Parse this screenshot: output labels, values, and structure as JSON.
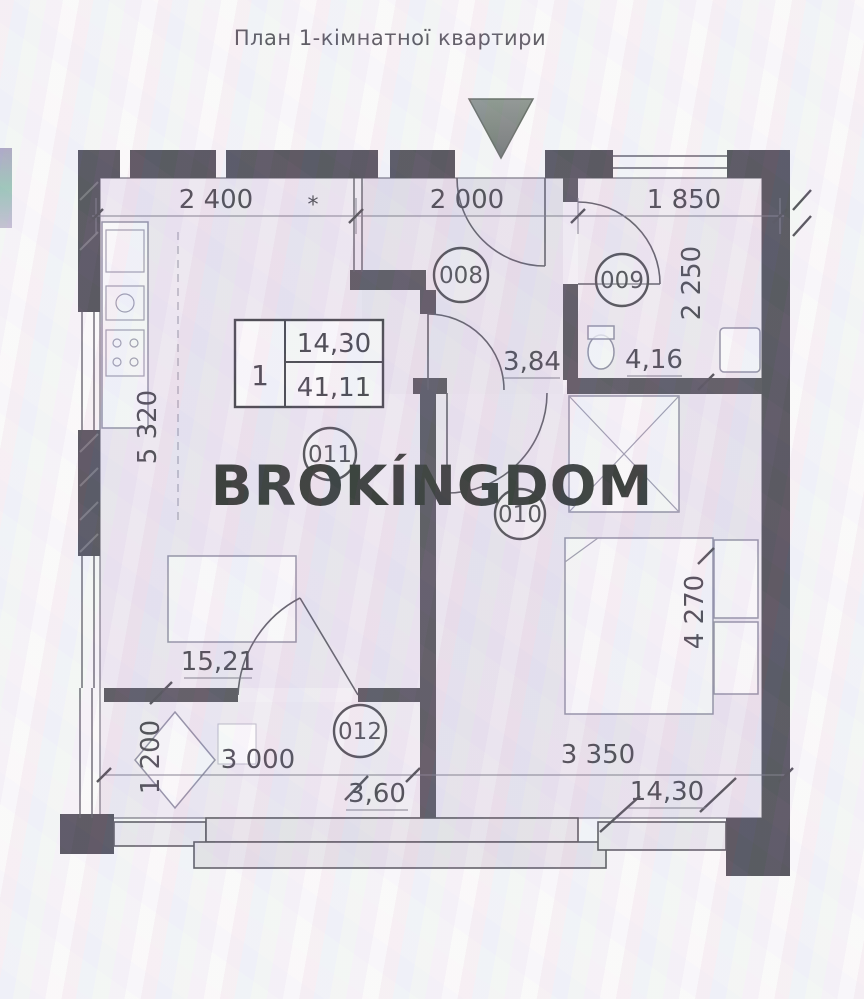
{
  "title": "План 1-кімнатної квартири",
  "watermark": "BROKÍNGDOM",
  "stamp": {
    "flat_number": "1",
    "living_area": "14,30",
    "total_area": "41,11"
  },
  "rooms": [
    {
      "number": "008",
      "area": "3,84"
    },
    {
      "number": "009",
      "area": "4,16"
    },
    {
      "number": "010",
      "area": "14,30"
    },
    {
      "number": "011",
      "area": "15,21"
    },
    {
      "number": "012",
      "area": "3,60"
    }
  ],
  "dimensions": {
    "top": [
      "2 400",
      "2 000",
      "1 850"
    ],
    "top_mark": "*",
    "left_upper": "5 320",
    "left_lower": "1 200",
    "right_upper": "2 250",
    "right_lower": "4 270",
    "bottom": [
      "3 000",
      "3 350"
    ]
  },
  "colors": {
    "wall": "#4c4a54",
    "interior_wall": "#53505a",
    "text": "#45424c",
    "watermark": "#2b302d",
    "entrance_triangle": "#79817c"
  }
}
